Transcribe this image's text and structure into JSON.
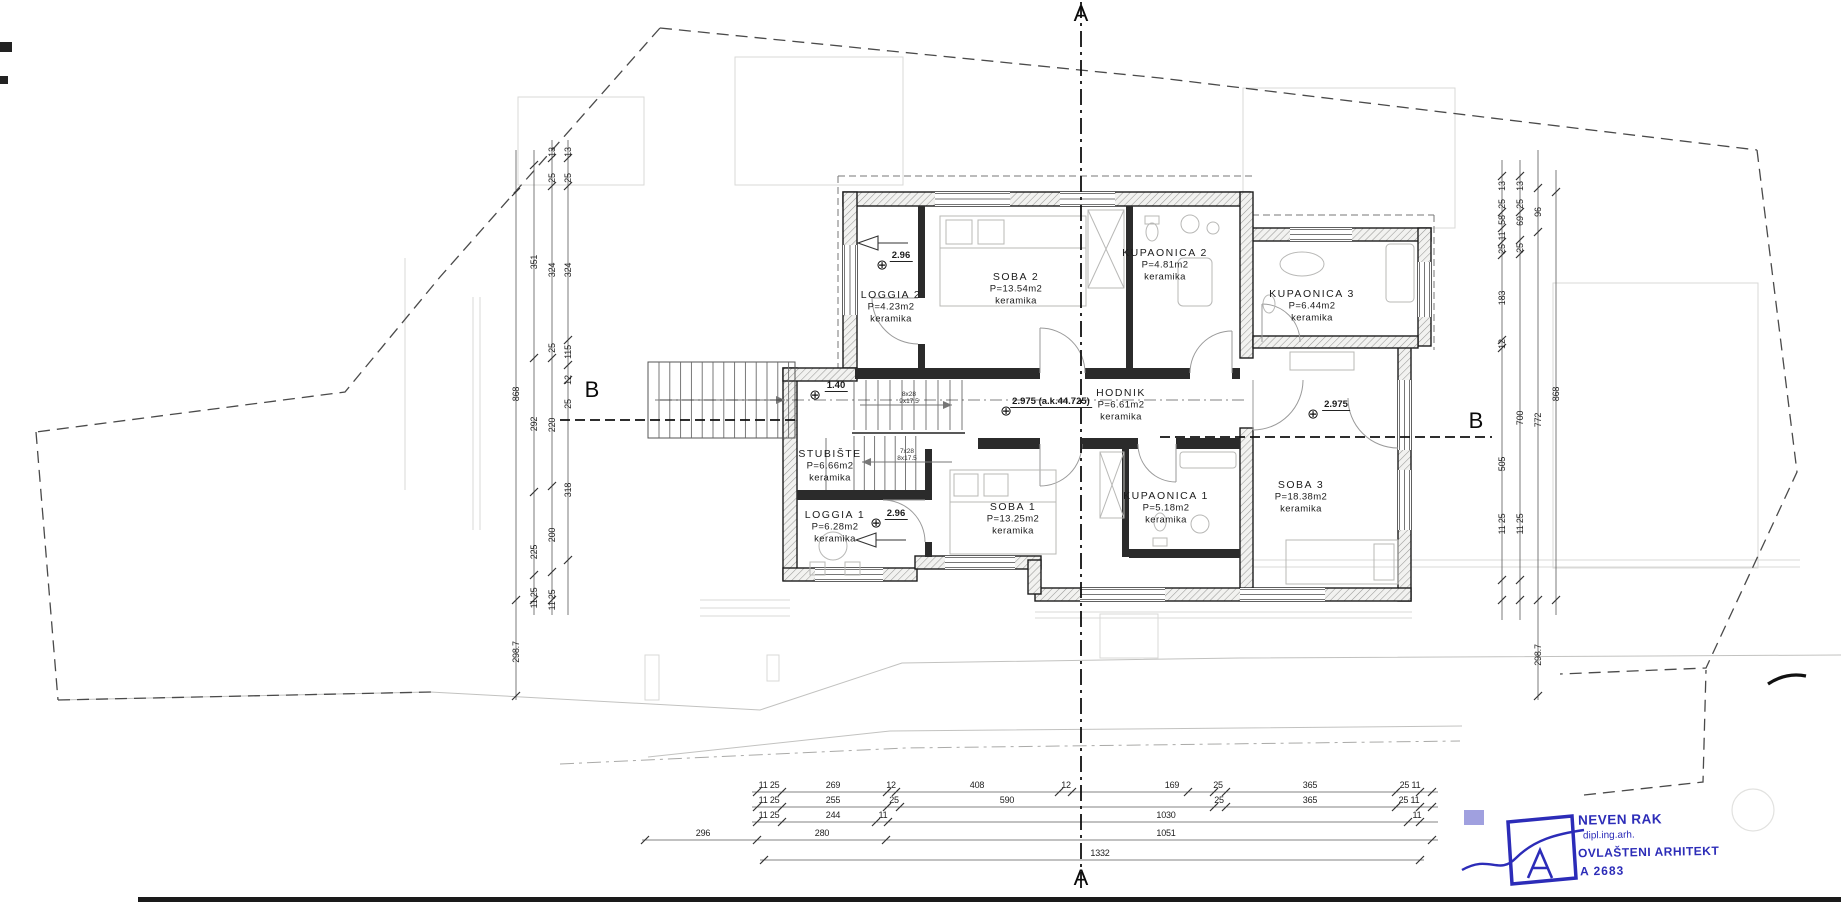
{
  "drawing": {
    "type": "floor-plan",
    "section_markers": [
      {
        "label": "A",
        "x": 1081,
        "y": 14
      },
      {
        "label": "A",
        "x": 1081,
        "y": 878
      },
      {
        "label": "B",
        "x": 592,
        "y": 390
      },
      {
        "label": "B",
        "x": 1476,
        "y": 421
      }
    ]
  },
  "rooms": [
    {
      "name": "LOGGIA 2",
      "area": "P=4.23m2",
      "finish": "keramika",
      "x": 891,
      "y": 295
    },
    {
      "name": "SOBA 2",
      "area": "P=13.54m2",
      "finish": "keramika",
      "x": 1016,
      "y": 277
    },
    {
      "name": "KUPAONICA 2",
      "area": "P=4.81m2",
      "finish": "keramika",
      "x": 1165,
      "y": 253
    },
    {
      "name": "KUPAONICA 3",
      "area": "P=6.44m2",
      "finish": "keramika",
      "x": 1312,
      "y": 294
    },
    {
      "name": "HODNIK",
      "area": "P=6.61m2",
      "finish": "keramika",
      "x": 1121,
      "y": 393
    },
    {
      "name": "STUBIŠTE",
      "area": "P=6.66m2",
      "finish": "keramika",
      "x": 830,
      "y": 454
    },
    {
      "name": "LOGGIA 1",
      "area": "P=6.28m2",
      "finish": "keramika",
      "x": 835,
      "y": 515
    },
    {
      "name": "SOBA 1",
      "area": "P=13.25m2",
      "finish": "keramika",
      "x": 1013,
      "y": 507
    },
    {
      "name": "KUPAONICA 1",
      "area": "P=5.18m2",
      "finish": "keramika",
      "x": 1166,
      "y": 496
    },
    {
      "name": "SOBA 3",
      "area": "P=18.38m2",
      "finish": "keramika",
      "x": 1301,
      "y": 485
    }
  ],
  "elevations": [
    {
      "value": "2.96",
      "sym_x": 882,
      "sym_y": 266,
      "txt_x": 901,
      "txt_y": 262
    },
    {
      "value": "1.40",
      "sym_x": 815,
      "sym_y": 396,
      "txt_x": 836,
      "txt_y": 392
    },
    {
      "value": "2.975 (a.k.44.725)",
      "sym_x": 1006,
      "sym_y": 412,
      "txt_x": 1051,
      "txt_y": 408
    },
    {
      "value": "2.975",
      "sym_x": 1313,
      "sym_y": 415,
      "txt_x": 1336,
      "txt_y": 411
    },
    {
      "value": "2.96",
      "sym_x": 876,
      "sym_y": 524,
      "txt_x": 896,
      "txt_y": 520
    }
  ],
  "stair_specs": [
    {
      "steps": "8x28",
      "risers": "9x17.5",
      "x": 909,
      "y": 398
    },
    {
      "steps": "7x28",
      "risers": "8x17.5",
      "x": 907,
      "y": 455
    }
  ],
  "dimensions": {
    "left_columns": [
      {
        "x": 516,
        "labels": [
          {
            "t": "868",
            "y": 394
          },
          {
            "t": "298.7",
            "y": 652
          }
        ]
      },
      {
        "x": 534,
        "labels": [
          {
            "t": "351",
            "y": 262
          },
          {
            "t": "292",
            "y": 424
          },
          {
            "t": "225",
            "y": 552
          },
          {
            "t": "11 25",
            "y": 598
          }
        ]
      },
      {
        "x": 552,
        "labels": [
          {
            "t": "13",
            "y": 152
          },
          {
            "t": "25",
            "y": 178
          },
          {
            "t": "324",
            "y": 270
          },
          {
            "t": "25",
            "y": 348
          },
          {
            "t": "220",
            "y": 425
          },
          {
            "t": "200",
            "y": 535
          },
          {
            "t": "11 25",
            "y": 600
          }
        ]
      },
      {
        "x": 568,
        "labels": [
          {
            "t": "13",
            "y": 152
          },
          {
            "t": "25",
            "y": 178
          },
          {
            "t": "324",
            "y": 270
          },
          {
            "t": "115",
            "y": 352
          },
          {
            "t": "12",
            "y": 380
          },
          {
            "t": "25",
            "y": 404
          },
          {
            "t": "318",
            "y": 490
          }
        ]
      }
    ],
    "right_columns": [
      {
        "x": 1502,
        "labels": [
          {
            "t": "13",
            "y": 186
          },
          {
            "t": "25",
            "y": 204
          },
          {
            "t": "58",
            "y": 220
          },
          {
            "t": "11",
            "y": 236
          },
          {
            "t": "25",
            "y": 249
          },
          {
            "t": "183",
            "y": 298
          },
          {
            "t": "12",
            "y": 344
          },
          {
            "t": "505",
            "y": 464
          },
          {
            "t": "11 25",
            "y": 524
          }
        ]
      },
      {
        "x": 1520,
        "labels": [
          {
            "t": "13",
            "y": 186
          },
          {
            "t": "25",
            "y": 204
          },
          {
            "t": "69",
            "y": 221
          },
          {
            "t": "25",
            "y": 248
          },
          {
            "t": "700",
            "y": 418
          },
          {
            "t": "11 25",
            "y": 524
          }
        ]
      },
      {
        "x": 1538,
        "labels": [
          {
            "t": "96",
            "y": 212
          },
          {
            "t": "772",
            "y": 420
          },
          {
            "t": "298.7",
            "y": 655
          }
        ]
      },
      {
        "x": 1556,
        "labels": [
          {
            "t": "868",
            "y": 394
          }
        ]
      }
    ],
    "bottom_rows": [
      {
        "y": 792,
        "labels": [
          {
            "t": "11 25",
            "x": 769
          },
          {
            "t": "269",
            "x": 833
          },
          {
            "t": "12",
            "x": 891
          },
          {
            "t": "408",
            "x": 977
          },
          {
            "t": "12",
            "x": 1066
          },
          {
            "t": "169",
            "x": 1172
          },
          {
            "t": "25",
            "x": 1218
          },
          {
            "t": "365",
            "x": 1310
          },
          {
            "t": "25 11",
            "x": 1410
          }
        ]
      },
      {
        "y": 807,
        "labels": [
          {
            "t": "11 25",
            "x": 769
          },
          {
            "t": "255",
            "x": 833
          },
          {
            "t": "25",
            "x": 894
          },
          {
            "t": "590",
            "x": 1007
          },
          {
            "t": "25",
            "x": 1219
          },
          {
            "t": "365",
            "x": 1310
          },
          {
            "t": "25 11",
            "x": 1409
          }
        ]
      },
      {
        "y": 822,
        "labels": [
          {
            "t": "11 25",
            "x": 769
          },
          {
            "t": "244",
            "x": 833
          },
          {
            "t": "11",
            "x": 883
          },
          {
            "t": "1030",
            "x": 1166
          },
          {
            "t": "11",
            "x": 1417
          }
        ]
      },
      {
        "y": 840,
        "labels": [
          {
            "t": "296",
            "x": 703
          },
          {
            "t": "280",
            "x": 822
          },
          {
            "t": "1051",
            "x": 1166
          }
        ]
      },
      {
        "y": 860,
        "labels": [
          {
            "t": "1332",
            "x": 1100
          }
        ]
      }
    ]
  },
  "stamp": {
    "architect": "NEVEN RAK",
    "degree": "dipl.ing.arh.",
    "license": "OVLAŠTENI ARHITEKT",
    "license_no": "A 2683",
    "color": "#2c2cb8"
  }
}
